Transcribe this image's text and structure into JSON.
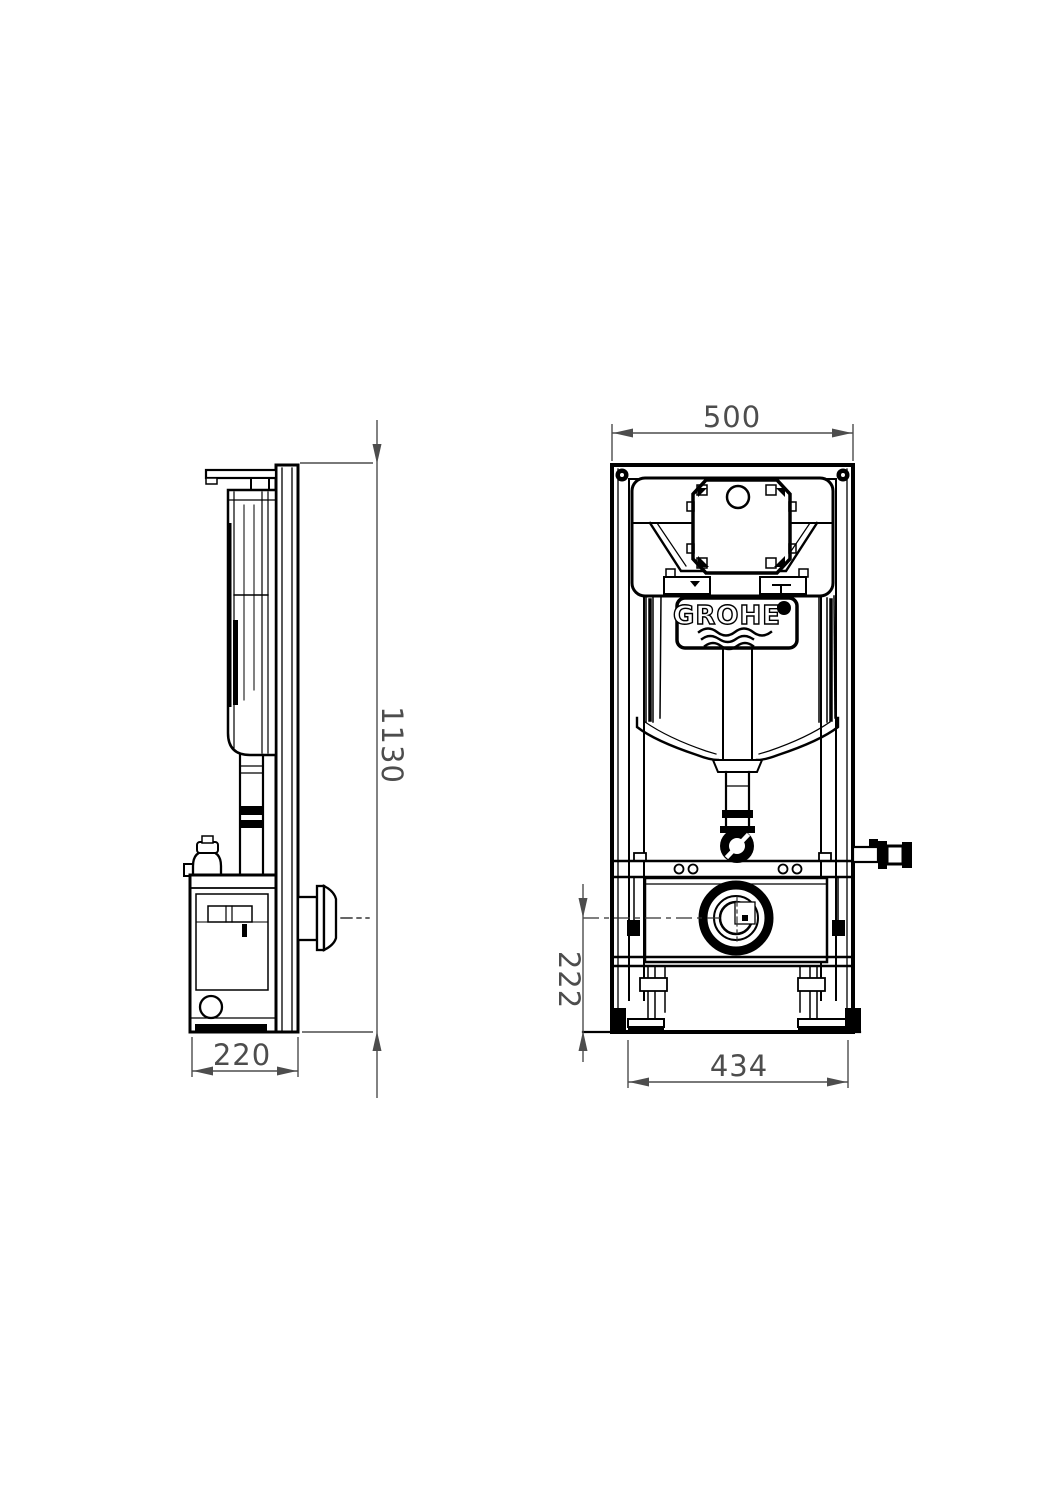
{
  "title": "GROHE concealed cistern installation frame - dimensional drawing",
  "brand": "GROHE",
  "views": {
    "left": "side-view",
    "right": "front-view"
  },
  "dimensions": {
    "frame_width": "500",
    "frame_height": "1130",
    "frame_depth": "220",
    "outlet_center_height": "222",
    "foot_spacing": "434"
  },
  "colors": {
    "line": "#000000",
    "dimension": "#4d4d4d",
    "background": "#ffffff"
  }
}
